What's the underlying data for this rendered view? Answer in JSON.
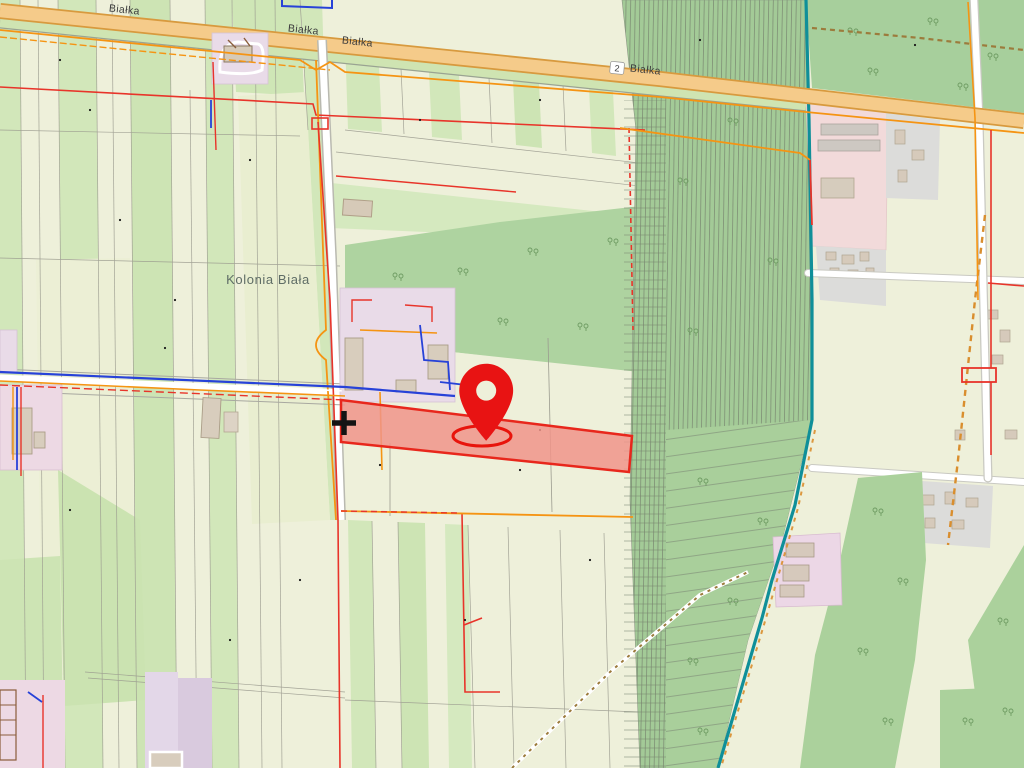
{
  "map": {
    "roads": {
      "bialka_label_1": "Białka",
      "bialka_label_2": "Białka",
      "bialka_label_3": "Białka",
      "bialka_ref": "2",
      "bialka_label_4": "Białka"
    },
    "places": {
      "kolonia_biala": "Kolonia Biała"
    },
    "marker": {
      "kind": "location-pin",
      "ring": "ellipse-halo"
    },
    "colors": {
      "field_pale": "#eef0da",
      "field_green": "#d2e7ba",
      "forest_green": "#a3ca97",
      "forest_light": "#a7cf9c",
      "road_fill": "#f5cb8a",
      "road_casing": "#d89a3e",
      "highlight_parcel_fill": "#f0948a",
      "highlight_parcel_border": "#e8271c",
      "pin_red": "#e81313",
      "boundary_teal": "#0f8f99",
      "utility_orange": "#f59413",
      "utility_red": "#e8342a",
      "utility_blue": "#2742d8",
      "village_pink": "#f2dada",
      "plot_lavender": "#e9dbe8",
      "residential_gray": "#dcdcda",
      "label_gray": "#3d3d3d"
    }
  }
}
